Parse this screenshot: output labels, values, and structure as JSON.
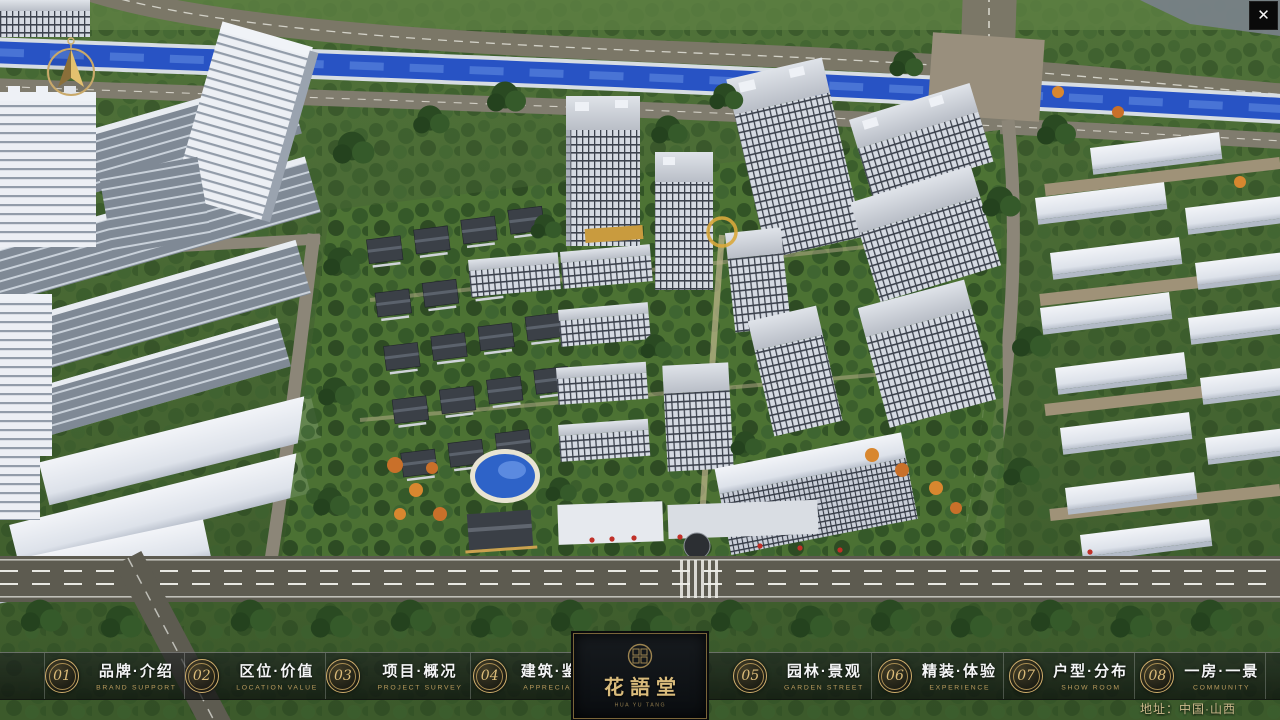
{
  "window": {
    "close_glyph": "✕"
  },
  "navigation": {
    "items": [
      {
        "number": "01",
        "title": "品牌·介绍",
        "subtitle": "BRAND SUPPORT"
      },
      {
        "number": "02",
        "title": "区位·价值",
        "subtitle": "LOCATION VALUE"
      },
      {
        "number": "03",
        "title": "项目·概况",
        "subtitle": "PROJECT SURVEY"
      },
      {
        "number": "04",
        "title": "建筑·鉴赏",
        "subtitle": "APPRECIATION"
      },
      {
        "number": "05",
        "title": "园林·景观",
        "subtitle": "GARDEN STREET"
      },
      {
        "number": "06",
        "title": "精装·体验",
        "subtitle": "EXPERIENCE"
      },
      {
        "number": "07",
        "title": "户型·分布",
        "subtitle": "SHOW ROOM"
      },
      {
        "number": "08",
        "title": "一房·一景",
        "subtitle": "COMMUNITY"
      }
    ]
  },
  "logo": {
    "title": "花語堂",
    "subtitle": "HUA YU TANG"
  },
  "footer": {
    "address": "地址：中国·山西"
  },
  "scene": {
    "type": "aerial-3d-masterplan-render"
  },
  "colors": {
    "gold": "#c9a96a",
    "river_blue": "#2853c4",
    "navbar_bg": "rgba(14,16,17,0.6)"
  }
}
